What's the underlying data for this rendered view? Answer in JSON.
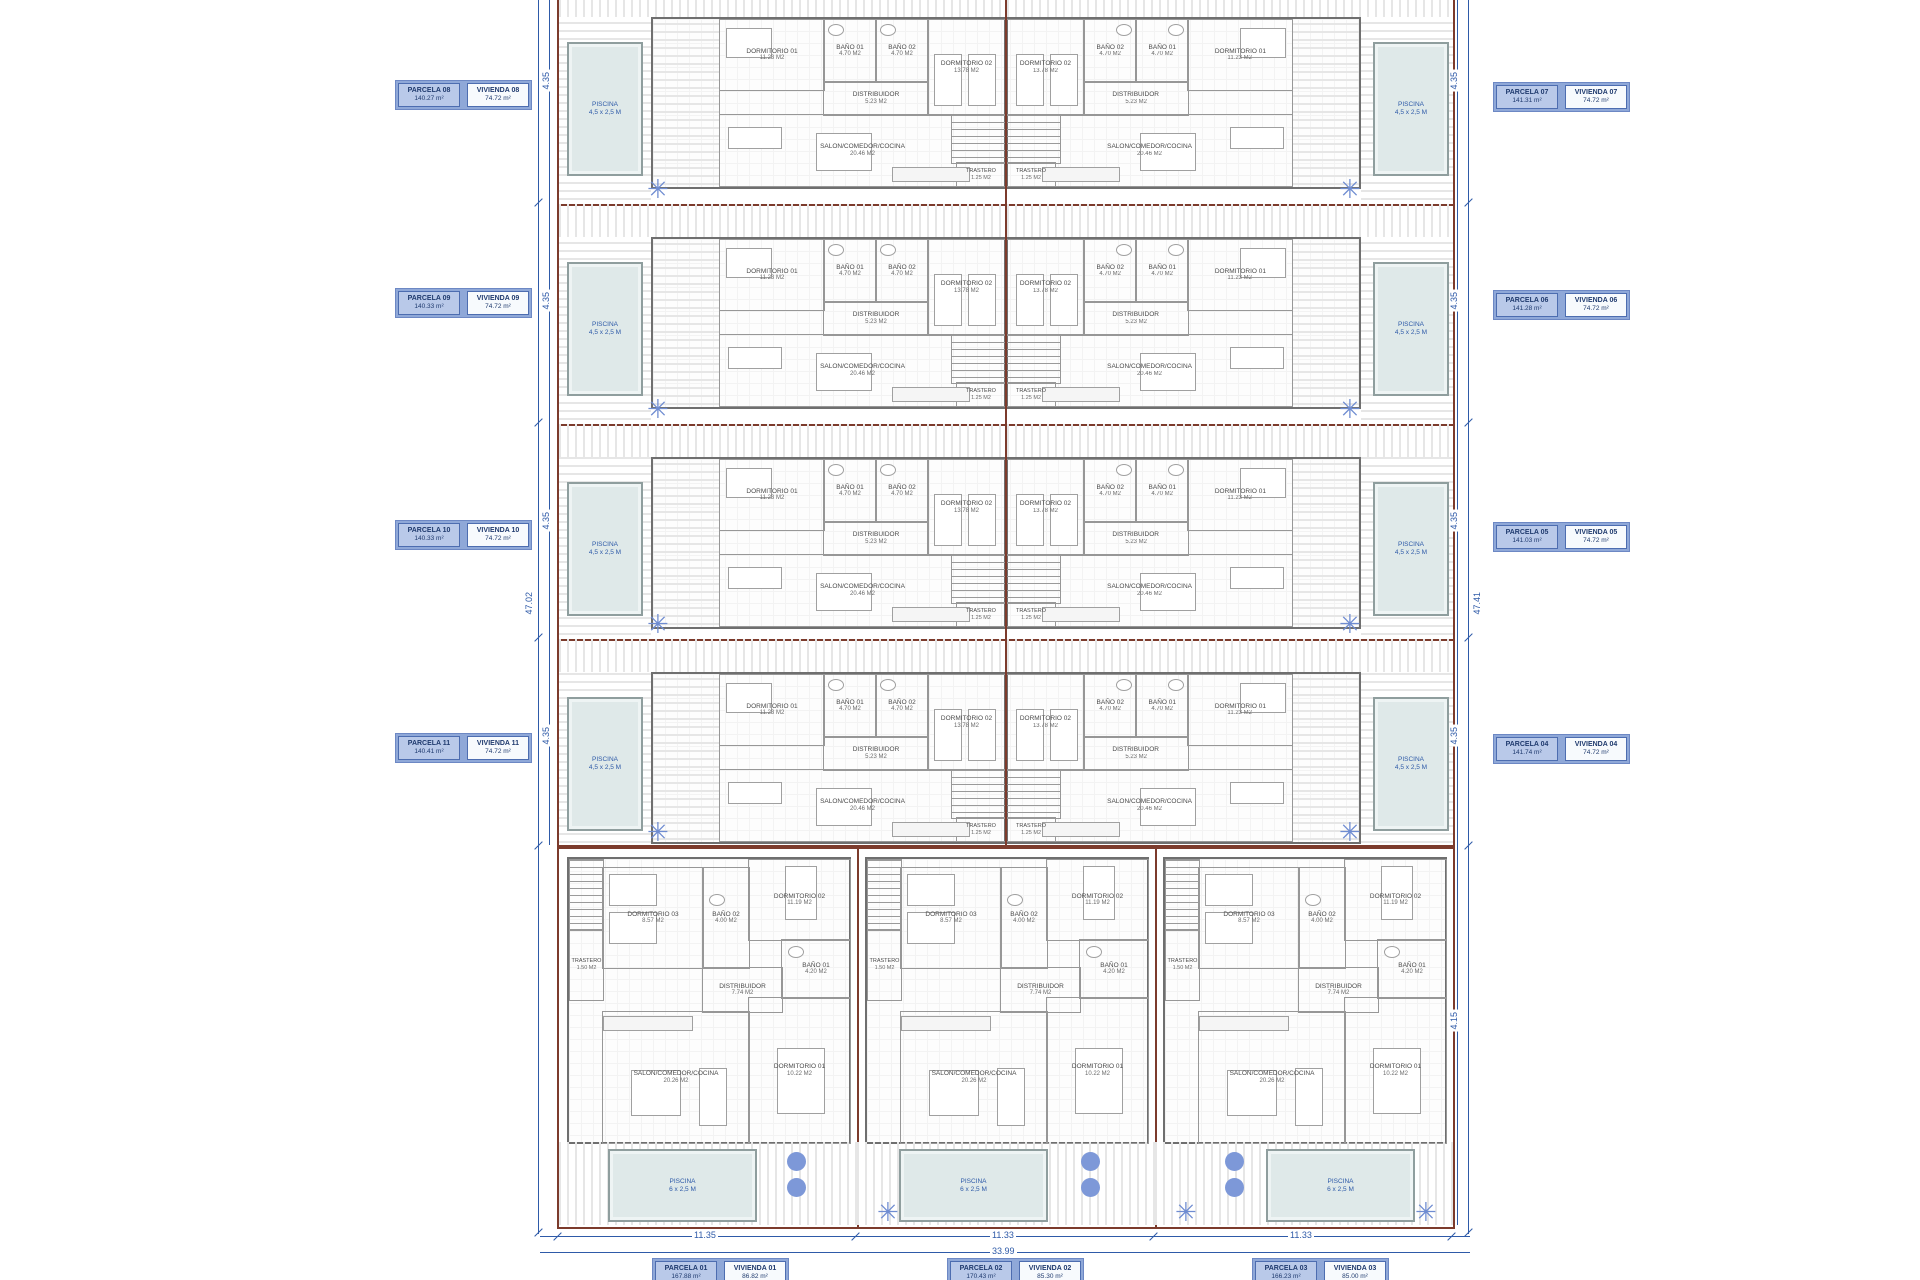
{
  "site": {
    "labels_left": [
      {
        "parcela": "PARCELA 08",
        "parcela_area": "140.27 m²",
        "vivienda": "VIVIENDA 08",
        "vivienda_area": "74.72 m²"
      },
      {
        "parcela": "PARCELA 09",
        "parcela_area": "140.33 m²",
        "vivienda": "VIVIENDA 09",
        "vivienda_area": "74.72 m²"
      },
      {
        "parcela": "PARCELA 10",
        "parcela_area": "140.33 m²",
        "vivienda": "VIVIENDA 10",
        "vivienda_area": "74.72 m²"
      },
      {
        "parcela": "PARCELA 11",
        "parcela_area": "140.41 m²",
        "vivienda": "VIVIENDA 11",
        "vivienda_area": "74.72 m²"
      }
    ],
    "labels_right": [
      {
        "parcela": "PARCELA 07",
        "parcela_area": "141.31 m²",
        "vivienda": "VIVIENDA 07",
        "vivienda_area": "74.72 m²"
      },
      {
        "parcela": "PARCELA 06",
        "parcela_area": "141.28 m²",
        "vivienda": "VIVIENDA 06",
        "vivienda_area": "74.72 m²"
      },
      {
        "parcela": "PARCELA 05",
        "parcela_area": "141.03 m²",
        "vivienda": "VIVIENDA 05",
        "vivienda_area": "74.72 m²"
      },
      {
        "parcela": "PARCELA 04",
        "parcela_area": "141.74 m²",
        "vivienda": "VIVIENDA 04",
        "vivienda_area": "74.72 m²"
      }
    ],
    "labels_bottom": [
      {
        "parcela": "PARCELA 01",
        "parcela_area": "167.88 m²",
        "vivienda": "VIVIENDA 01",
        "vivienda_area": "86.82 m²"
      },
      {
        "parcela": "PARCELA 02",
        "parcela_area": "170.43 m²",
        "vivienda": "VIVIENDA 02",
        "vivienda_area": "85.30 m²"
      },
      {
        "parcela": "PARCELA 03",
        "parcela_area": "166.23 m²",
        "vivienda": "VIVIENDA 03",
        "vivienda_area": "85.00 m²"
      }
    ]
  },
  "unit_rooms": {
    "dorm1": "DORMITORIO 01",
    "dorm1_area": "11.23 M2",
    "bath1": "BAÑO 01",
    "bath1_area": "4.70 M2",
    "bath2": "BAÑO 02",
    "bath2_area": "4.70 M2",
    "dorm2": "DORMITORIO 02",
    "dorm2_area": "13.78 M2",
    "distrib": "DISTRIBUIDOR",
    "distrib_area": "5.23 M2",
    "salon": "SALON/COMEDOR/COCINA",
    "salon_area": "20.46 M2",
    "trastero": "TRASTERO",
    "trastero_area": "1.25 M2",
    "piscina": "PISCINA",
    "piscina_size": "4,5 x 2,5 M"
  },
  "villa_rooms": {
    "dorm3": "DORMITORIO 03",
    "dorm3_area": "8.57 M2",
    "bath2": "BAÑO 02",
    "bath2_area": "4.00 M2",
    "dorm2": "DORMITORIO 02",
    "dorm2_area": "11.19 M2",
    "bath1": "BAÑO 01",
    "bath1_area": "4.20 M2",
    "distrib": "DISTRIBUIDOR",
    "distrib_area": "7.74 M2",
    "salon": "SALON/COMEDOR/COCINA",
    "salon_area": "20.26 M2",
    "dorm1": "DORMITORIO 01",
    "dorm1_area": "10.22 M2",
    "trastero": "TRASTERO",
    "trastero_area": "1.50 M2",
    "piscina": "PISCINA",
    "piscina_size": "6 x 2,5 M"
  },
  "dims": {
    "left_total": "47.02",
    "right_total": "47.41",
    "row_left": [
      "4.35",
      "4.35",
      "4.35",
      "4.35"
    ],
    "row_right": [
      "4.35",
      "4.35",
      "4.35",
      "4.35"
    ],
    "villa_side": "4.15",
    "bottom_widths": [
      "11.35",
      "11.33",
      "11.33"
    ],
    "bottom_total": "33.99"
  },
  "colors": {
    "parcel_boundary": "#7c3b2c",
    "dimension_blue": "#2e5aa8",
    "label_fill": "#b9c9e9",
    "label_band": "#8fa8d8",
    "pool_fill": "#dfe9e9",
    "tree_blue": "#7d98d8",
    "wall_gray": "#6f6f6f"
  }
}
